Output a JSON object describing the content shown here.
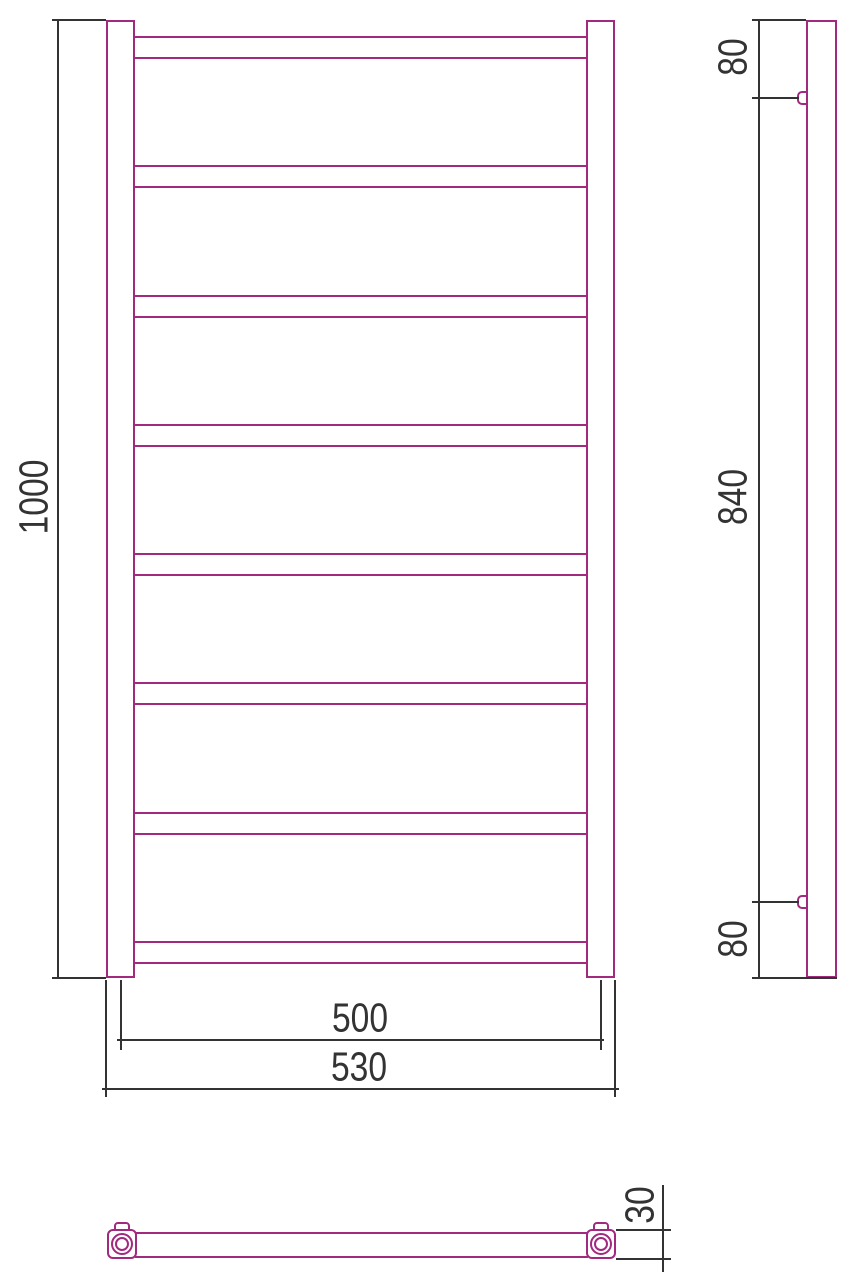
{
  "colors": {
    "outline": "#a1297e",
    "dimension": "#333333"
  },
  "front_view": {
    "height_label": "1000",
    "axis_width_label": "500",
    "overall_width_label": "530",
    "rung_tops": [
      36,
      165,
      295,
      424,
      553,
      682,
      812,
      941
    ]
  },
  "side_view": {
    "top_offset_label": "80",
    "bracket_span_label": "840",
    "bottom_offset_label": "80"
  },
  "plan_view": {
    "depth_label": "30"
  }
}
